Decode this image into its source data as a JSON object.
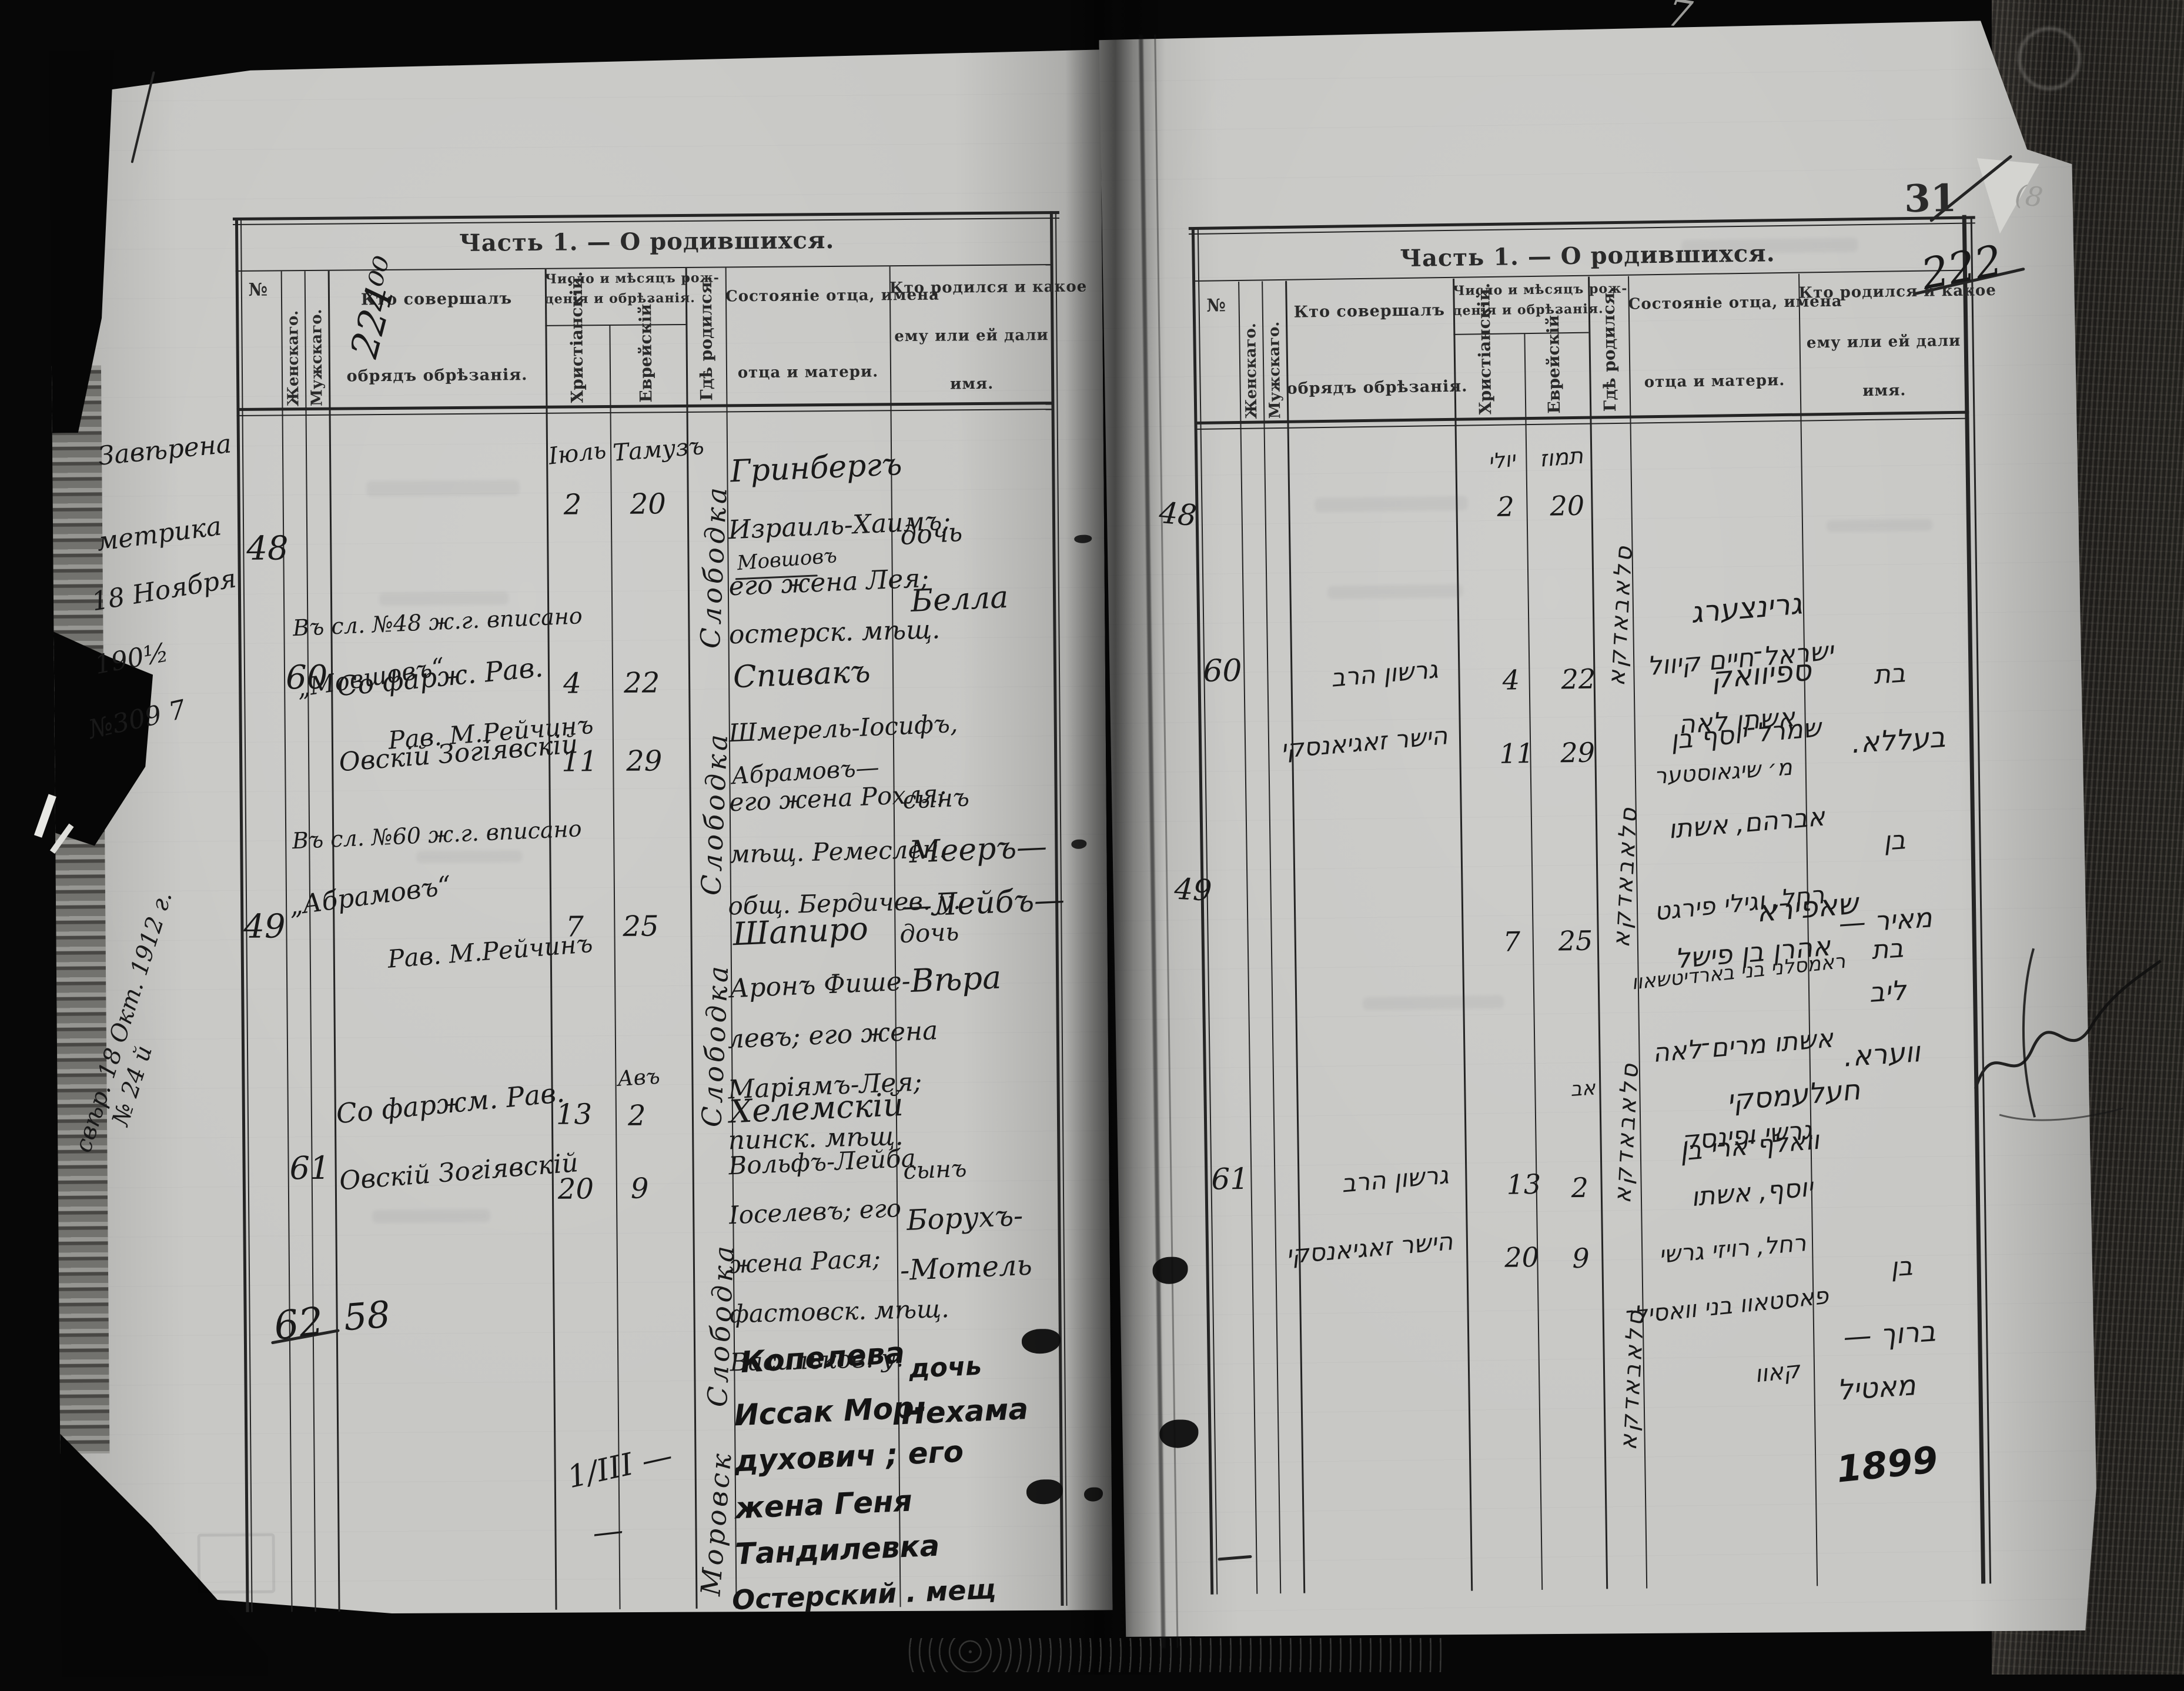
{
  "scan": {
    "top_pencil_mark": "7",
    "folio_number": "31",
    "folio_slash_note": "(8"
  },
  "header": {
    "title": "Часть 1. — О родившихся.",
    "col_no": "№",
    "col_female": "Женскаго.",
    "col_male": "Мужскаго.",
    "col_performer_1": "Кто совершалъ",
    "col_performer_2": "обрядъ обрѣзанія.",
    "col_dates_1": "Число и мѣсяцъ рож-",
    "col_dates_2": "денія и обрѣзанія.",
    "col_christian": "Христіанскій.",
    "col_jewish": "Еврейскій.",
    "col_where_born": "Гдѣ родился.",
    "col_father_1": "Состояніе отца, имена",
    "col_father_2": "отца и матери.",
    "col_child_1": "Кто родился и какое",
    "col_child_2": "ему или ей дали",
    "col_child_3": "имя."
  },
  "left_page": {
    "corner_annotation": "224⁰⁰",
    "margin_note": [
      "Завѣрена",
      "метрика",
      "18 Ноября",
      "190½",
      "№309 7"
    ],
    "margin_note_vertical_1": "свѣр. 18 Окт. 1912 г.",
    "margin_note_vertical_2": "№ 24 й",
    "rows": [
      {
        "no": "48",
        "chr": [
          "Іюль",
          "2"
        ],
        "jew": [
          "Тамузъ",
          "20"
        ],
        "place": "Слободка",
        "father": [
          "Гринбергъ",
          "Израиль-Хаимъ;",
          "Мовшовъ",
          "его жена Лея;",
          "остерск. мѣщ."
        ],
        "child": [
          "дочь",
          "Белла"
        ],
        "note": [
          "Въ сл. №48 ж.г. вписано",
          "„Мовшовъ“",
          "Рав. М.Рейчинъ"
        ]
      },
      {
        "no": "60",
        "performer": [
          "Со фарж. Рав.",
          "Овскій Зогіявскій"
        ],
        "chr": [
          "4",
          "11"
        ],
        "jew": [
          "22",
          "29"
        ],
        "place": "Слободка",
        "father": [
          "Спивакъ",
          "Шмерель-Іосифъ,",
          "Абрамовъ—",
          "его жена Рохля;",
          "мѣщ. Ремеслен.",
          "общ. Бердичев. у."
        ],
        "child": [
          "сынъ",
          "Мееръ—",
          "—Лейбъ—"
        ],
        "note": [
          "Въ сл. №60 ж.г. вписано",
          "„Абрамовъ“",
          "Рав. М.Рейчинъ"
        ]
      },
      {
        "no": "49",
        "chr": [
          "7"
        ],
        "jew": [
          "25"
        ],
        "place": "Слободка",
        "father": [
          "Шапиро",
          "Аронъ Фише-",
          "левъ; его жена",
          "Маріямъ-Лея;",
          "пинск. мѣщ."
        ],
        "child": [
          "дочь",
          "Вѣра"
        ]
      },
      {
        "no": "61",
        "performer": [
          "Со фаржм. Рав.",
          "Овскій Зогіявскій"
        ],
        "chr": [
          "13",
          "20"
        ],
        "jew": [
          "Авъ",
          "2",
          "9"
        ],
        "place": "Слободка",
        "father": [
          "Хелемскій",
          "Вольфъ-Лейба",
          "Іоселевъ; его",
          "жена Рася;",
          "фастовск. мѣщ.",
          "Васильков. у."
        ],
        "child": [
          "сынъ",
          "Борухъ-",
          "-Мотель"
        ]
      },
      {
        "no": "62",
        "no2": "58",
        "chr": [
          "1/ІІІ —",
          "—"
        ],
        "place": "Моровск",
        "father": [
          "Копелева",
          "Иссак Мор-",
          "духович ; его",
          "жена Геня",
          "Тандилевка",
          "Остерский . мещ"
        ],
        "child": [
          "дочь",
          "Нехама"
        ]
      }
    ]
  },
  "right_page": {
    "corner_annotation": "222",
    "rows": [
      {
        "no": "48",
        "chr": [
          "יולי",
          "2"
        ],
        "jew": [
          "תמוז",
          "20"
        ],
        "place": "סלאבאדקא",
        "father": [
          "גרינצערג",
          "ישראל־חיים קיוול",
          "אשתו לאה",
          "מ׳ שיגאוסטער"
        ],
        "child": [
          "בת",
          "בעללא."
        ]
      },
      {
        "no": "60",
        "performer": [
          "גרשון הרב",
          "הישר זאגיאנסקי"
        ],
        "chr": [
          "4",
          "11"
        ],
        "jew": [
          "22",
          "29"
        ],
        "place": "סלאבאדקא",
        "father": [
          "ספיוואק",
          "שמרל־יוסף בן",
          "אברהם, אשתו",
          "רחל, וגילי פירגט",
          "ראמסלני בני בארדיטשאוו"
        ],
        "child": [
          "בן",
          "מאיר —",
          "ליב"
        ]
      },
      {
        "no": "49",
        "chr": [
          "7"
        ],
        "jew": [
          "25"
        ],
        "place": "סלאבאדקא",
        "father": [
          "שאפירא",
          "אהרן בן פישל",
          "אשתו מרים־לאה",
          "גרשי ופינסק"
        ],
        "child": [
          "בת",
          "ווערא."
        ]
      },
      {
        "no": "61",
        "performer": [
          "גרשון הרב",
          "הישר זאגיאנסקי"
        ],
        "chr": [
          "13",
          "20"
        ],
        "jew": [
          "אב",
          "2",
          "9"
        ],
        "place": "סלאבאדקא",
        "father": [
          "חעלעמסקי",
          "וואלף־ארי בן",
          "יוסף, אשתו",
          "רחל, רויזי גרשי",
          "פאסטאוו בני וואסיל־",
          "קאוו"
        ],
        "child": [
          "בן",
          "ברוך —",
          "מאטיל"
        ],
        "year": "1899"
      }
    ]
  }
}
